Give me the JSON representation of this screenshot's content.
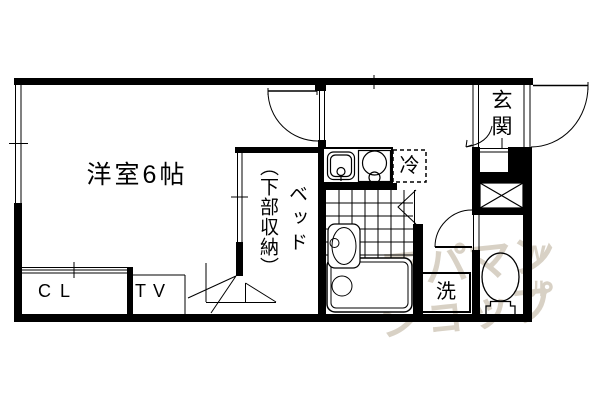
{
  "plan": {
    "labels": {
      "room": "洋室6帖",
      "bed_main": "ベッド",
      "bed_sub": "（下部収納）",
      "closet": "CL",
      "tv": "TV",
      "fridge": "冷",
      "entrance": "玄関",
      "washer": "洗"
    },
    "watermark": {
      "line1": "アパマン",
      "line2": "ショップ",
      "mark1": "W",
      "mark2": "ル"
    },
    "colors": {
      "wall": "#000000",
      "background": "#ffffff",
      "watermark": "#d8d1c5"
    }
  }
}
